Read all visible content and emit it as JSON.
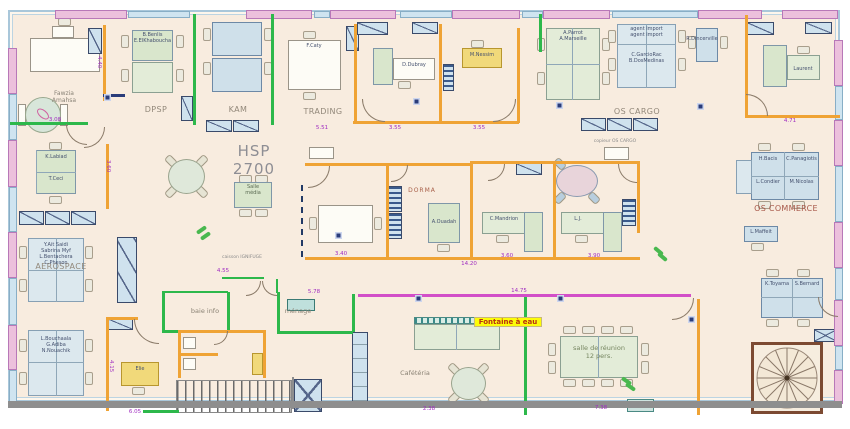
{
  "plan_title": "HSP 2700",
  "rooms": {
    "dpsp": "DPSP",
    "kam": "KAM",
    "trading": "TRADING",
    "os_cargo": "OS CARGO",
    "os_commerce": "OS COMMERCE",
    "aerospace": "AEROSPACE",
    "baie_info": "baie info",
    "menage": "ménage",
    "cafeteria": "Cafétéria",
    "salle_reunion": "salle de réunion\n12 pers.",
    "salle_media": "Salle\nmédia",
    "dorma": "DORMA"
  },
  "annotations": {
    "copieur": "copieur OS CARGO",
    "caisson": "caisson IGNIFUGE",
    "fontaine": "Fontaine à eau"
  },
  "people": {
    "fawzia": "Fawzia\nAmahsa",
    "dpsp_desk": "B.Benlis\nE.ElKhaboucha",
    "f_caty": "F.Caty",
    "d_dubray": "D.Dubray",
    "m_nessim": "M.Nessim",
    "parrot": "A.Parrot\nA.Marseille",
    "agents": "agent import\nagent import",
    "garcio": "C.GarcioRac\nB.DosMedinas",
    "dincerville": "R.Dincerville",
    "laurent": "Laurent",
    "k_labiad": "K.Labiad",
    "t_ceci": "T.Ceci",
    "a_ouadah": "A.Ouadah",
    "c_mandrion": "C.Mandrion",
    "l_j": "L.J.",
    "h_bacis": "H.Bacis",
    "c_panagiotis": "C.Panagiotis",
    "l_condier": "L.Condier",
    "m_nicolas": "M.Nicolas",
    "l_maffeit": "L.Maffeit",
    "k_toyama": "K.Toyama",
    "s_bernard": "S.Bernard",
    "aero_team1": "Y.Ait Saidi\nSabrina Myf\nL.Bentachera\nC.Pheson",
    "aero_team2": "L.Bouchaala\nG.Adiba\nN.Nouachik",
    "elie": "Elie"
  },
  "d": {
    "a440": "4.40",
    "a308": "3.08",
    "a551": "5.51",
    "a355a": "3.55",
    "a355b": "3.55",
    "a471": "4.71",
    "a360v": "3.60",
    "a340": "3.40",
    "a360": "3.60",
    "a390": "3.90",
    "a1420": "14.20",
    "a455": "4.55",
    "a578": "5.78",
    "a1475": "14.75",
    "a415": "4.15",
    "a605": "6.05",
    "a238": "2.38",
    "a738": "7.38"
  }
}
